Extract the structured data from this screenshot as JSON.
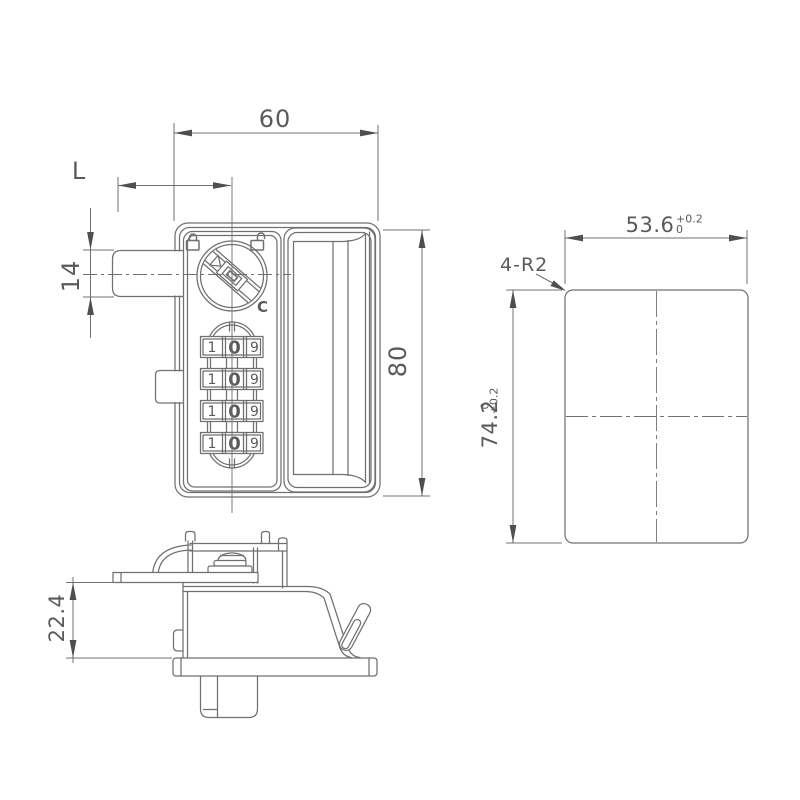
{
  "drawing": {
    "type": "technical-drawing",
    "subject": "keyless-combination-cam-lock",
    "colors": {
      "line": "#707070",
      "text": "#5a5a5a",
      "arrow": "#4f4f4f",
      "background": "#ffffff"
    },
    "front_view": {
      "dim_width": "60",
      "dim_grip_length": "L",
      "dim_tube_height": "14",
      "dim_height": "80",
      "dial": {
        "reset_label": "C",
        "locked_icon": "closed-padlock",
        "unlocked_icon": "open-padlock"
      },
      "wheels": {
        "rows": 4,
        "digits": [
          "1",
          "0",
          "9"
        ]
      }
    },
    "side_view": {
      "dim_depth": "22.4"
    },
    "cutout_view": {
      "dim_width": "53.6",
      "dim_width_tol_upper": "+0.2",
      "dim_width_tol_lower": "0",
      "dim_height": "74.2",
      "dim_height_tol_upper": "+0.2",
      "dim_height_tol_lower": "0",
      "corner_radius_note": "4-R2"
    }
  }
}
